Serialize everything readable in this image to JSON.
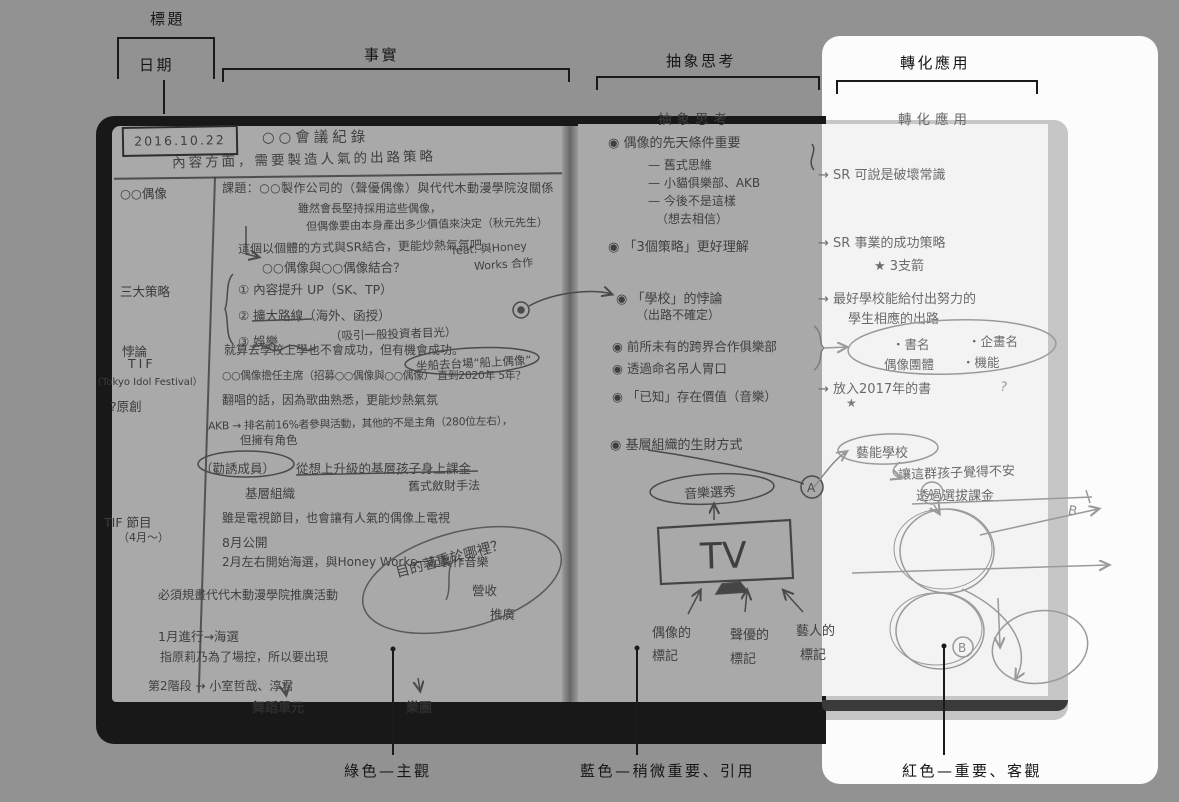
{
  "annotations": {
    "top": {
      "title": "標題",
      "date": "日期",
      "facts": "事實",
      "abstract": "抽象思考",
      "apply": "轉化應用"
    },
    "bottom": {
      "green": "綠色—主觀",
      "blue": "藍色—稍微重要、引用",
      "red": "紅色—重要、客觀"
    }
  },
  "notebook": {
    "date": "2016.10.22",
    "left": {
      "title": "○○會議紀錄",
      "subtitle": "內容方面，需要製造人氣的出路策略",
      "margin_idol": "○○偶像",
      "margin_strategies": "三大策略",
      "margin_paradox": "悖論",
      "margin_tif": "TIF",
      "margin_tif_full": "（Tokyo Idol Festival）",
      "margin_original": "?原創",
      "margin_program": "TIF 節目",
      "margin_program2": "（4月～）",
      "topic": "課題：○○製作公司的（聲優偶像）與代代木動漫學院沒關係",
      "topic_note1": "雖然會長堅持採用這些偶像，",
      "topic_note2": "但偶像要由本身產出多少價值來決定（秋元先生）",
      "sr_note": "這個以個體的方式與SR結合，更能炒熱氣氛吧",
      "combine": "○○偶像與○○偶像結合？",
      "feat1": "feat. 與Honey",
      "feat2": "Works 合作",
      "s1": "① 內容提升 UP（SK、TP）",
      "s2": "② 擴大路線（海外、函授）",
      "s3": "③ 娛樂",
      "s3_note": "（吸引一般投資者目光）",
      "paradox_text": "就算去學校上學也不會成功，但有機會成功。",
      "boat": "坐船去台場“船上偶像”",
      "chair": "○○偶像擔任主席（招募○○偶像與○○偶像） 直到2020年 5年？",
      "cover_song": "翻唱的話，因為歌曲熟悉，更能炒熱氣氛",
      "akb": "AKB → 排名前16%者參與活動，其他的不是主角（280位左右），",
      "akb2": "但擁有角色",
      "recruit": "（勸誘成員）",
      "recruit2": "從想上升級的基層孩子身上課金",
      "base_org": "基層組織",
      "money_method": "舊式斂財手法",
      "tv_show": "雖是電視節目，也會讓有人氣的偶像上電視",
      "aug": "8月公開",
      "feb": "2月左右開始海選，與Honey Works一起製作音樂",
      "purpose": "目的著重於哪裡？",
      "revenue": "營收",
      "promo": "推廣",
      "plan": "必須規畫代代木動漫學院推廣活動",
      "jan": "1月進行→海選",
      "sashihara": "指原莉乃為了場控，所以要出現",
      "stage2": "第2階段 → 小室哲哉、淳君",
      "dance": "舞蹈單元",
      "band": "樂團"
    },
    "middle": {
      "header": "抽象思考",
      "b1": "◉ 偶像的先天條件重要",
      "b1_1": "— 舊式思維",
      "b1_2": "— 小貓俱樂部、AKB",
      "b1_3": "— 今後不是這樣",
      "b1_4": "（想去相信）",
      "b2": "◉ 「3個策略」更好理解",
      "b3": "◉ 「學校」的悖論",
      "b3_1": "（出路不確定）",
      "b4": "◉ 前所未有的跨界合作俱樂部",
      "b5": "◉ 透過命名吊人胃口",
      "b6": "◉ 「已知」存在價值（音樂）",
      "b7": "◉ 基層組織的生財方式",
      "oval": "音樂選秀",
      "tv": "TV",
      "mark1a": "偶像的",
      "mark1b": "標記",
      "mark2a": "聲優的",
      "mark2b": "標記",
      "mark3a": "藝人的",
      "mark3b": "標記"
    },
    "right": {
      "header": "轉化應用",
      "r1": "→ SR 可說是破壞常識",
      "r2": "→ SR 事業的成功策略",
      "r2_1": "★ 3支箭",
      "r3a": "→ 最好學校能給付出努力的",
      "r3b": "學生相應的出路",
      "oval1a": "・書名",
      "oval1b": "・企畫名",
      "oval1c": "偶像團體",
      "oval1d": "・機能",
      "r4": "→ 放入2017年的書",
      "star": "★",
      "question": "?",
      "school": "藝能學校",
      "uneasy": "讓這群孩子覺得不安",
      "charge": "透過選拔課金",
      "a_label": "A",
      "b_label": "B"
    }
  }
}
